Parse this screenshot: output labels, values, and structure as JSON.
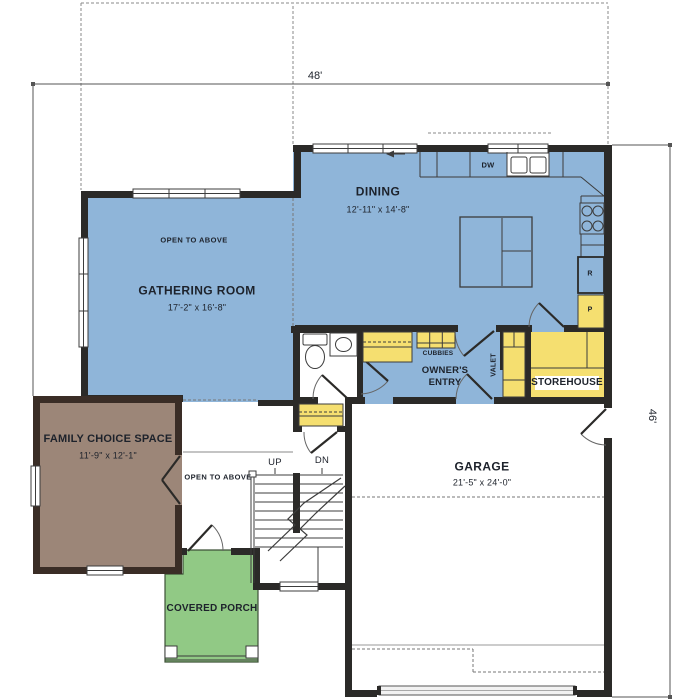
{
  "dimensions": {
    "width": "48'",
    "height": "46'"
  },
  "rooms": {
    "gathering": {
      "name": "GATHERING ROOM",
      "dims": "17'-2\" x 16'-8\"",
      "note": "OPEN TO ABOVE"
    },
    "dining": {
      "name": "DINING",
      "dims": "12'-11\" x 14'-8\""
    },
    "family": {
      "name": "FAMILY CHOICE SPACE",
      "dims": "11'-9\" x 12'-1\""
    },
    "garage": {
      "name": "GARAGE",
      "dims": "21'-5\" x 24'-0\""
    },
    "owners_entry": {
      "name": "OWNER'S ENTRY"
    },
    "storehouse": {
      "name": "STOREHOUSE"
    },
    "porch": {
      "name": "COVERED PORCH"
    },
    "stair_hall": {
      "up": "UP",
      "down": "DN",
      "note": "OPEN TO ABOVE"
    }
  },
  "fixtures": {
    "cubbies": "CUBBIES",
    "valet": "VALET",
    "dishwasher": "DW",
    "refrigerator": "R",
    "pantry": "P"
  },
  "colors": {
    "floor_blue": "#8FB5D9",
    "floor_yellow": "#F5DF70",
    "floor_brown": "#9C8678",
    "floor_green": "#91C985",
    "wall_black": "#2B2A28",
    "wall_brown": "#3A2D26",
    "line_gray": "#3C3C3C",
    "label_ink": "#1d222b"
  }
}
